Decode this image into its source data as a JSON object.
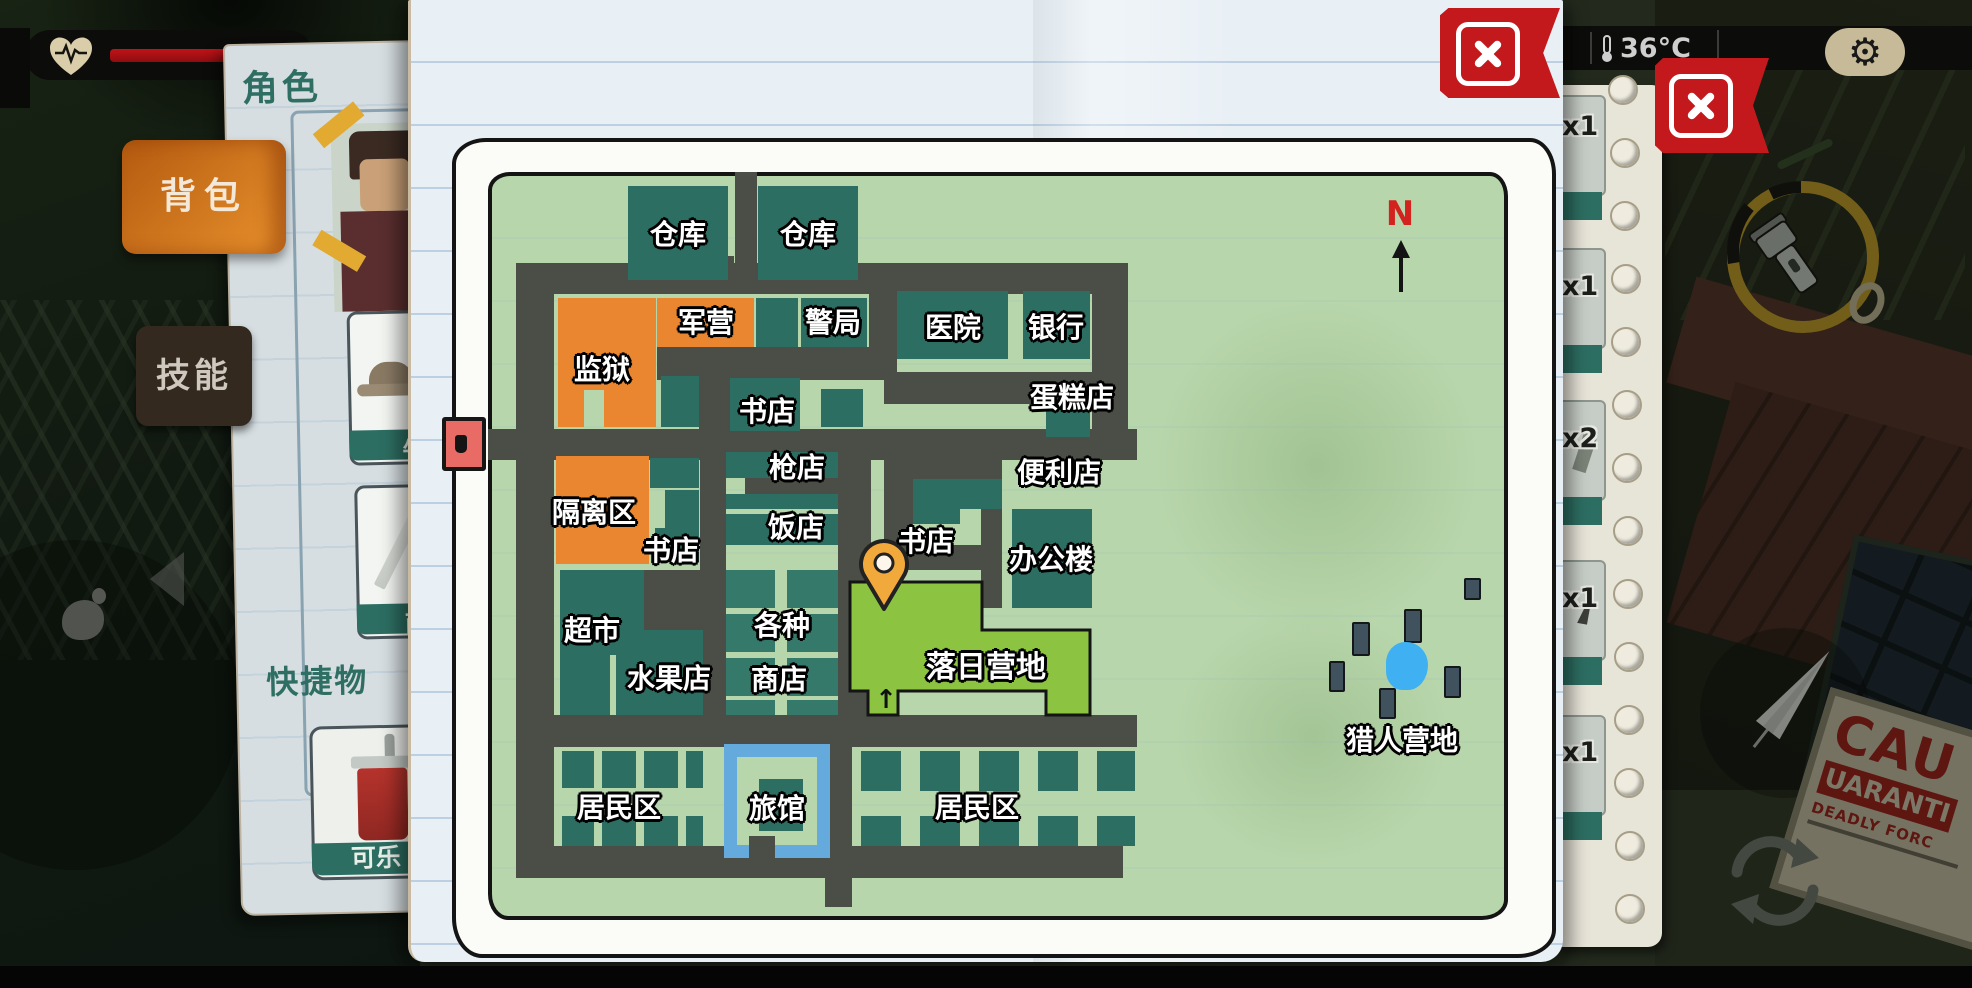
{
  "hud": {
    "temperature": "36°C",
    "backpack_tab": "背包",
    "skills_tab": "技能"
  },
  "character_panel": {
    "title": "角色",
    "hat_slot_label": "牛",
    "umbrella_slot_label": "雨",
    "quick_items_heading": "快捷物",
    "cola_label": "可乐"
  },
  "backpack_panel": {
    "badges": [
      "x1",
      "x1",
      "x2",
      "x1",
      "x1"
    ]
  },
  "map": {
    "compass": "N",
    "camp_entry_arrow": "↑",
    "labels": {
      "warehouse1": "仓库",
      "warehouse2": "仓库",
      "prison": "监狱",
      "barracks": "军营",
      "police": "警局",
      "hospital": "医院",
      "bank": "银行",
      "bookstore1": "书店",
      "cake_shop": "蛋糕店",
      "gun_shop": "枪店",
      "quarantine": "隔离区",
      "restaurant": "饭店",
      "bookstore2": "书店",
      "bookstore3": "书店",
      "convenience": "便利店",
      "office": "办公楼",
      "supermarket": "超市",
      "fruit_shop": "水果店",
      "various_shops_line1": "各种",
      "various_shops_line2": "商店",
      "sunset_camp": "落日营地",
      "residential1": "居民区",
      "hotel": "旅馆",
      "residential2": "居民区",
      "hunter_camp": "猎人营地"
    }
  },
  "caution_sign": {
    "line1": "CAU",
    "line2": "UARANTI",
    "line3": "DEADLY FORC"
  }
}
